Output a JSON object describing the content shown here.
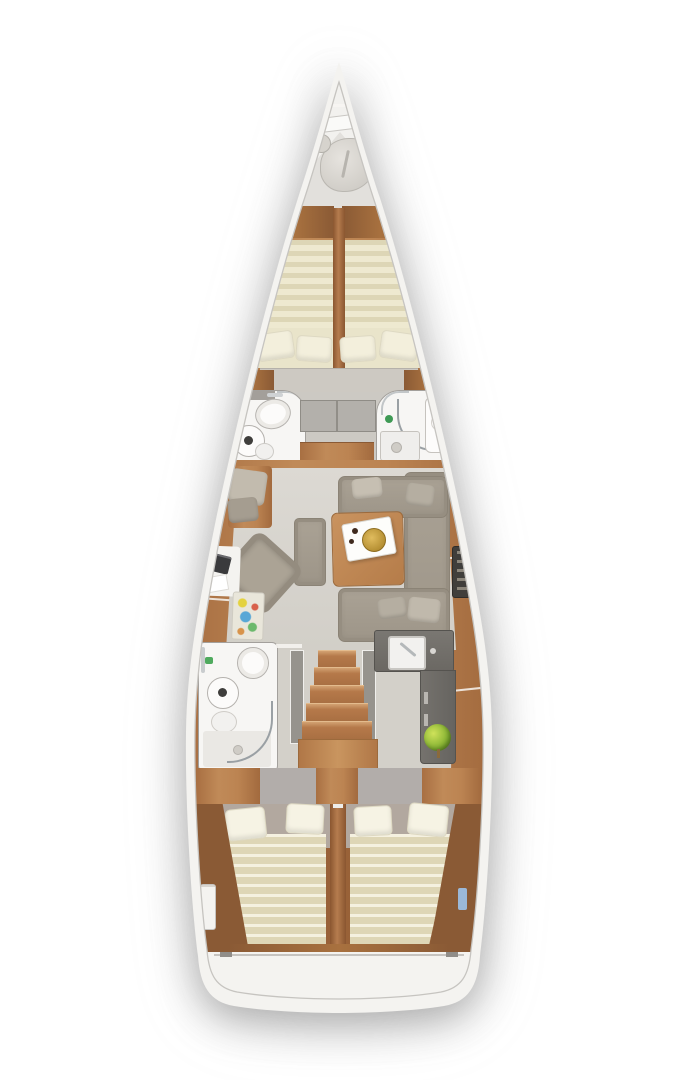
{
  "meta": {
    "title": "Sailing yacht interior floor plan, top-down 3D rendered view",
    "type": "floorplan",
    "canvas": {
      "width": 675,
      "height": 1080
    }
  },
  "palette": {
    "page_bg": "#ffffff",
    "hull_white": "#f4f3f0",
    "inner_edge_line": "#c6c4c0",
    "teak": "#b5794a",
    "teak_light": "#c08a58",
    "teak_dark": "#8a5a35",
    "floor_gray": "#d6d3cd",
    "wall_dark": "#55534e",
    "galley_counter": "#6f6c67",
    "upholstery_taupe": "#a29a8d",
    "cushion_light": "#b3aca0",
    "mattress_stripe_a": "#ddd6b6",
    "mattress_stripe_b": "#eee9d0",
    "duvet_stripe_a": "#f5f1e0",
    "duvet_stripe_b": "#ded6b6",
    "linen": "#f3efdc",
    "bath_white": "#f7f6f4",
    "chrome": "#c9ccce",
    "accent_gold": "#c9a23c",
    "accent_green": "#7fae2f",
    "accent_blue": "#9bb8d8",
    "chart_colors": [
      "#e4d23e",
      "#d8604a",
      "#58a7d6",
      "#6cb96c",
      "#d8934a"
    ]
  },
  "sections": {
    "bow": {
      "label": "Bow anchor locker",
      "items": [
        "windlass tube",
        "anchor rode bag",
        "bag knob"
      ]
    },
    "forward_cabin": {
      "label": "Forward V-berth cabin",
      "items": [
        "port berth striped mattress",
        "starboard berth striped mattress",
        "4 cream pillows",
        "center divider",
        "foot bench",
        "corner nightstands",
        "blue side hatch"
      ]
    },
    "forward_heads": {
      "port": {
        "label": "Port forward head",
        "items": [
          "vanity counter with faucet",
          "toilet",
          "round washbasin",
          "toilet roll",
          "green accessory"
        ]
      },
      "starboard": {
        "label": "Starboard forward head",
        "items": [
          "curved shower glass",
          "shower tray with drain",
          "vanity with basin",
          "green accessory"
        ]
      },
      "center": {
        "label": "Center corridor",
        "items": [
          "wardrobe cabinets",
          "teak floor strip"
        ]
      }
    },
    "salon": {
      "label": "Main salon",
      "items": [
        "U-shaped sofa starboard",
        "4 throw pillows",
        "square teak table",
        "white serving tray",
        "gold plate",
        "ottoman bench",
        "port corner seat",
        "diagonal armchair",
        "nav desk with laptop and papers",
        "multicolor sea chart",
        "bottle rack"
      ]
    },
    "galley": {
      "label": "L-shaped galley starboard aft",
      "items": [
        "dark worktop",
        "sink with faucet",
        "knob",
        "drawer handles",
        "green fruit bowl"
      ]
    },
    "companionway": {
      "label": "Companionway stairs",
      "items": [
        "5 teak treads",
        "landing platform",
        "gray side walls"
      ]
    },
    "aft_head": {
      "label": "Port aft head with shower",
      "items": [
        "toilet bowl",
        "round washbasin",
        "small basin",
        "curved shower glass",
        "shower floor with drain",
        "towel rail",
        "green accessory"
      ]
    },
    "aft_cabins": {
      "label": "Twin aft double cabins",
      "items": [
        "port double berth striped duvet",
        "starboard double berth striped duvet",
        "4 white pillows",
        "center divider",
        "3 wardrobe locker blocks",
        "tech panel",
        "blue hatch"
      ]
    },
    "stern": {
      "label": "Stern transom",
      "items": [
        "transom seam",
        "corner notches"
      ]
    }
  }
}
